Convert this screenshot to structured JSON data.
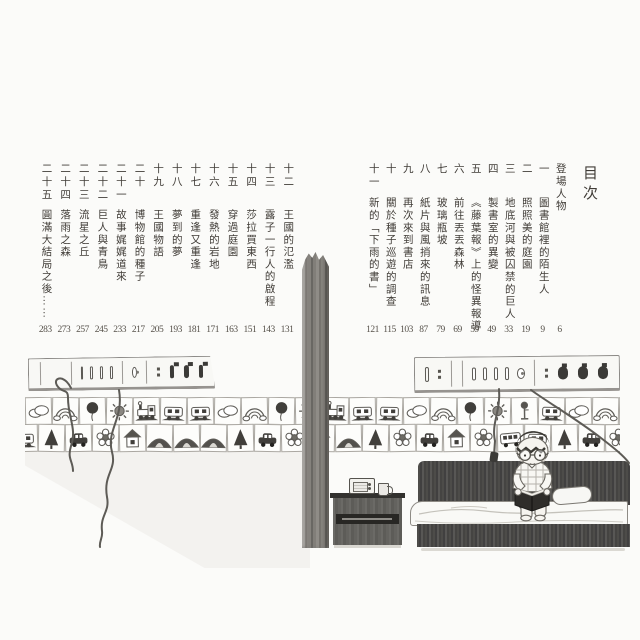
{
  "page_title": "目次",
  "toc_right": {
    "entries": [
      {
        "num": "",
        "label": "登場人物",
        "page": "6"
      },
      {
        "num": "一",
        "label": "圖書館裡的陌生人",
        "page": "9"
      },
      {
        "num": "二",
        "label": "照照美的庭園",
        "page": "19"
      },
      {
        "num": "三",
        "label": "地底河與被囚禁的巨人",
        "page": "33"
      },
      {
        "num": "四",
        "label": "製書室的異變",
        "page": "49"
      },
      {
        "num": "五",
        "label": "《藤葉報》上的怪異報導",
        "page": "59"
      },
      {
        "num": "六",
        "label": "前往丟丟森林",
        "page": "69"
      },
      {
        "num": "七",
        "label": "玻璃瓶坡",
        "page": "79"
      },
      {
        "num": "八",
        "label": "紙片與風捎來的訊息",
        "page": "87"
      },
      {
        "num": "九",
        "label": "再次來到書店",
        "page": "103"
      },
      {
        "num": "十",
        "label": "關於種子巡遊的調查",
        "page": "115"
      },
      {
        "num": "十一",
        "label": "新的「下雨的書」",
        "page": "121"
      }
    ]
  },
  "toc_left": {
    "entries": [
      {
        "num": "十二",
        "label": "王國的氾濫",
        "page": "131"
      },
      {
        "num": "十三",
        "label": "露子一行人的啟程",
        "page": "143"
      },
      {
        "num": "十四",
        "label": "莎拉買東西",
        "page": "151"
      },
      {
        "num": "十五",
        "label": "穿過庭園",
        "page": "163"
      },
      {
        "num": "十六",
        "label": "發熱的岩地",
        "page": "171"
      },
      {
        "num": "十七",
        "label": "重逢又重逢",
        "page": "181"
      },
      {
        "num": "十八",
        "label": "夢到的夢",
        "page": "193"
      },
      {
        "num": "十九",
        "label": "王國物語",
        "page": "205"
      },
      {
        "num": "二十",
        "label": "博物館的種子",
        "page": "217"
      },
      {
        "num": "二十一",
        "label": "故事娓娓道來",
        "page": "233"
      },
      {
        "num": "二十二",
        "label": "巨人與青鳥",
        "page": "245"
      },
      {
        "num": "二十三",
        "label": "流星之丘",
        "page": "257"
      },
      {
        "num": "二十四",
        "label": "落雨之森",
        "page": "273"
      },
      {
        "num": "二十五",
        "label": "圓滿大結局之後……",
        "page": "283"
      }
    ]
  },
  "illustration": {
    "border_top_row": [
      "cloud",
      "rainbow",
      "balloon",
      "sun",
      "loco",
      "wagon",
      "wagon",
      "cloud",
      "rainbow",
      "balloon",
      "sun",
      "loco",
      "wagon",
      "wagon",
      "cloud",
      "rainbow",
      "balloon",
      "sun",
      "signal",
      "wagon",
      "cloud",
      "rainbow",
      "balloon",
      "sun"
    ],
    "border_bottom_row": [
      "wagon",
      "tree",
      "car",
      "flower",
      "house",
      "hill",
      "hill",
      "hill",
      "tree",
      "car",
      "flower",
      "house",
      "hill",
      "tree",
      "flower",
      "car",
      "house",
      "flower",
      "bus",
      "wagon",
      "tree",
      "car",
      "flower",
      "house"
    ]
  },
  "colors": {
    "ink": "#403c37",
    "page_number": "#56514a",
    "dark_fill": "#3b3a37",
    "wood": "#76736e",
    "paper": "#fbfbf9",
    "wash": "#ecebe7"
  }
}
